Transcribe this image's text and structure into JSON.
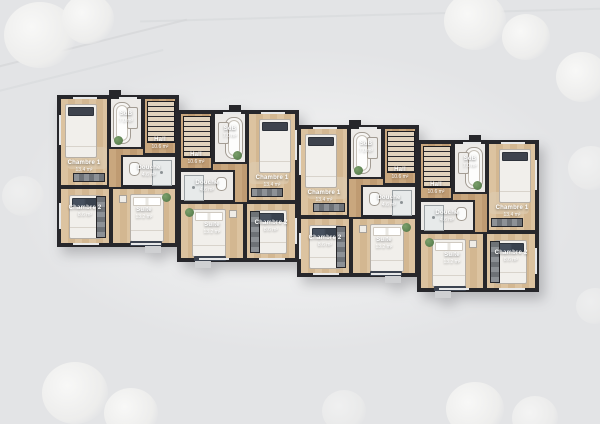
{
  "scene": {
    "type": "architectural-floor-plan",
    "background_color": "#e3e4e6",
    "wall_color": "#27272b",
    "wood_color": "#c9a77e",
    "tile_color": "#eceae7",
    "label_color": "#ffffff",
    "plant_color": "#4e7344"
  },
  "units": [
    {
      "name": "unit-1",
      "rooms": {
        "chambre1": {
          "label": "Chambre 1",
          "area": "13.4 m²"
        },
        "sdb": {
          "label": "SdB",
          "area": "7.0 m²"
        },
        "hall": {
          "label": "Hall",
          "area": "10.6 m²"
        },
        "douche": {
          "label": "Douche",
          "area": "4.6 m²"
        },
        "chambre2": {
          "label": "Chambre 2",
          "area": "8.6 m²"
        },
        "suite": {
          "label": "Suite",
          "area": "13.2 m²"
        }
      }
    },
    {
      "name": "unit-2",
      "rooms": {
        "chambre1": {
          "label": "Chambre 1",
          "area": "13.4 m²"
        },
        "sdb": {
          "label": "SdB",
          "area": "7.0 m²"
        },
        "hall": {
          "label": "Hall",
          "area": "10.6 m²"
        },
        "douche": {
          "label": "Douche",
          "area": "4.6 m²"
        },
        "chambre2": {
          "label": "Chambre 2",
          "area": "8.6 m²"
        },
        "suite": {
          "label": "Suite",
          "area": "13.2 m²"
        }
      }
    },
    {
      "name": "unit-3",
      "rooms": {
        "chambre1": {
          "label": "Chambre 1",
          "area": "13.4 m²"
        },
        "sdb": {
          "label": "SdB",
          "area": "7.0 m²"
        },
        "hall": {
          "label": "Hall",
          "area": "10.6 m²"
        },
        "douche": {
          "label": "Douche",
          "area": "4.6 m²"
        },
        "chambre2": {
          "label": "Chambre 2",
          "area": "8.6 m²"
        },
        "suite": {
          "label": "Suite",
          "area": "13.2 m²"
        }
      }
    },
    {
      "name": "unit-4",
      "rooms": {
        "chambre1": {
          "label": "Chambre 1",
          "area": "13.4 m²"
        },
        "sdb": {
          "label": "SdB",
          "area": "7.0 m²"
        },
        "hall": {
          "label": "Hall",
          "area": "10.6 m²"
        },
        "douche": {
          "label": "Douche",
          "area": "4.6 m²"
        },
        "chambre2": {
          "label": "Chambre 2",
          "area": "8.6 m²"
        },
        "suite": {
          "label": "Suite",
          "area": "13.2 m²"
        }
      }
    }
  ]
}
